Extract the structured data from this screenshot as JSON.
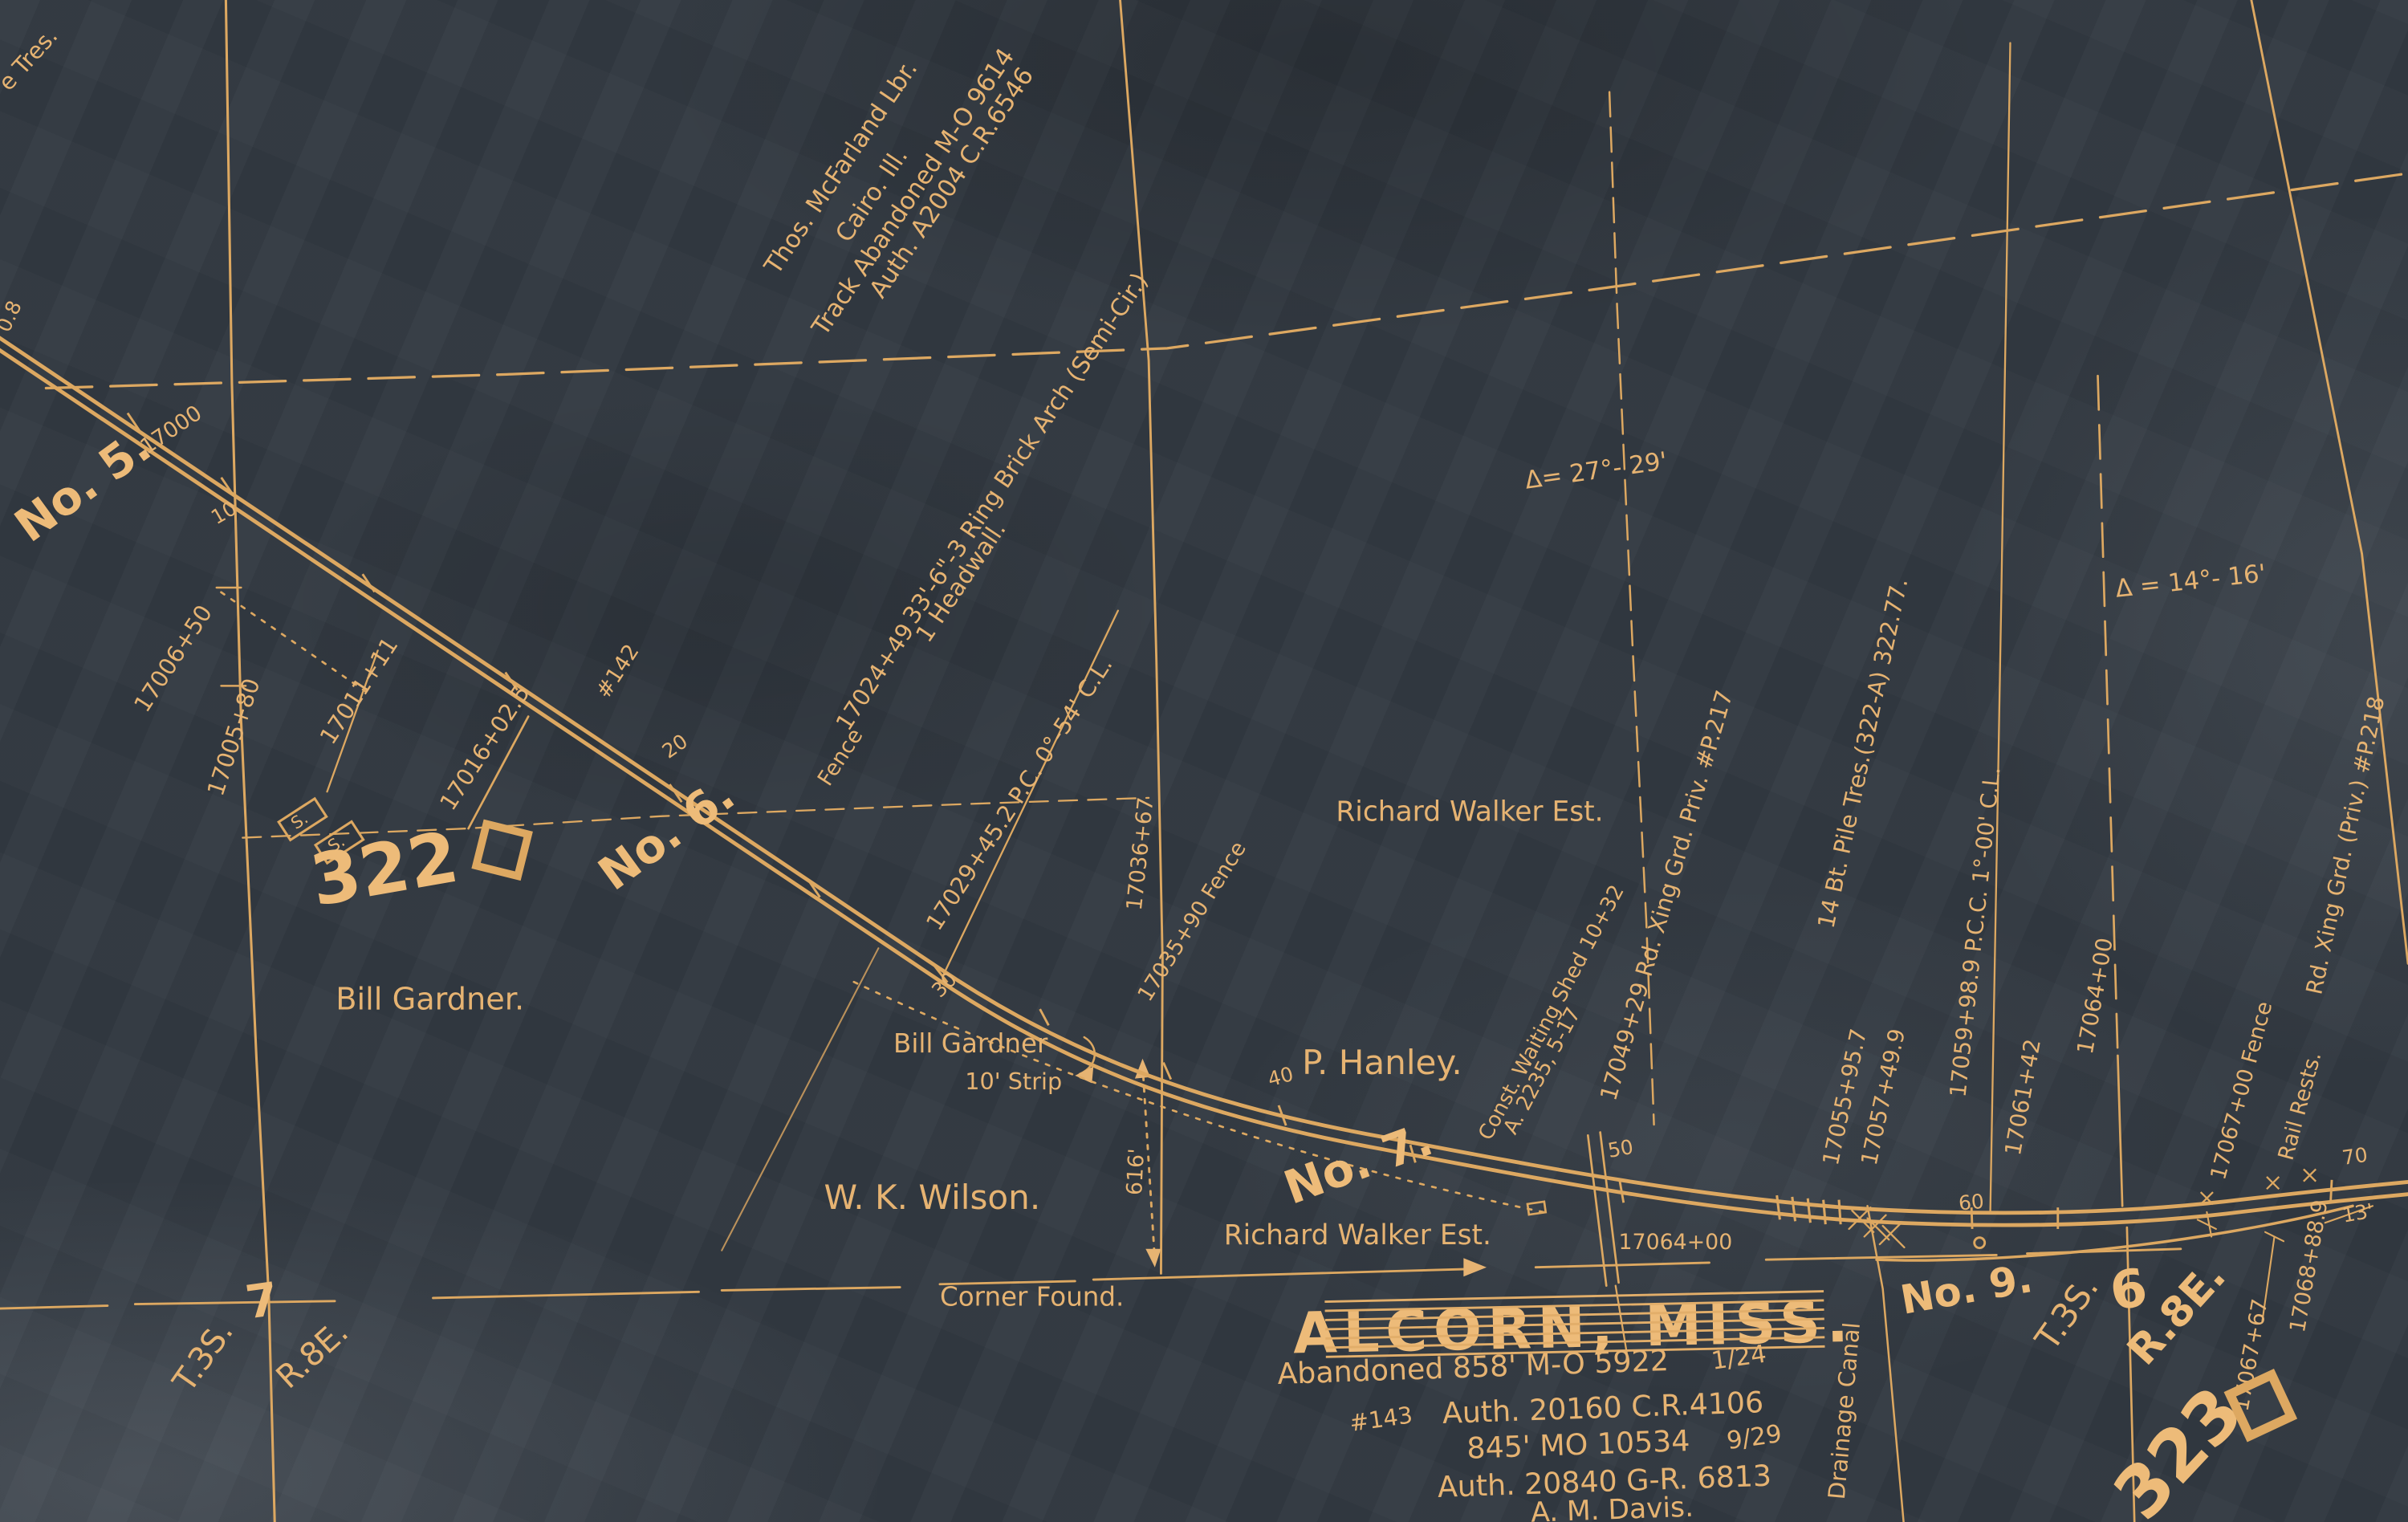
{
  "colors": {
    "ink": "#e6b372",
    "paper": "#333a42"
  },
  "corner_fragments": {
    "tres": "e Tres.",
    "zero_eight": "0.8"
  },
  "mcfarland_note": {
    "line1": "Thos. McFarland Lbr.",
    "line2": "Cairo. Ill.",
    "line3": "Track Abandoned M-O 9614",
    "line4": "Auth. A2004 C.R.6546"
  },
  "arch_note": {
    "line1": "33'-6\"-3 Ring Brick Arch (Semi-Cir.)",
    "line2": "1 Headwall."
  },
  "track": {
    "no5": "No. 5.",
    "no6": "No. 6.",
    "no7": "No. 7.",
    "no9": "No. 9.",
    "s17000": "17000",
    "s10": "10",
    "s20": "20",
    "s30": "30",
    "s40": "40",
    "s50": "50",
    "s60": "60",
    "s70": "70"
  },
  "station_notes": {
    "s17006_50": "17006+50",
    "s17005_80": "17005+80",
    "s17011_11": "17011+11",
    "s17016_02": "17016+02.5",
    "fence_word": "Fence",
    "s17024_49": "17024+49",
    "num142": "#142",
    "pc_note": "17029+45.2  P.C. 0°-54' C.L.",
    "s17036_67": "17036+67",
    "fence_17035": "17035+90 Fence",
    "rd_xing_217": "17049+29 Rd. Xing Grd. Priv. #P.217",
    "waiting_shed1": "Const. Waiting Shed 10+32",
    "waiting_shed2": "A. 2235, 5-17",
    "pile_trestle": "14 Bt. Pile Tres.(322-A) 322.77.",
    "s17055": "17055+95.7",
    "s17057": "17057+49.9",
    "pcc_note": "17059+98.9  P.C.C.  1°-00' C.L.",
    "s17061": "17061+42",
    "s17064_v": "17064+00",
    "s17064_h": "17064+00",
    "fence_17067": "17067+00 Fence",
    "rail_rests": "Rail Rests.",
    "s17068": "17068+88.9",
    "s17067_67": "17067+67",
    "thirteen": "13'",
    "rd_xing_218": "Rd. Xing Grd. (Priv.) #P.218",
    "delta27": "Δ= 27°- 29'",
    "delta14": "Δ = 14°- 16'",
    "dim_616": "616'"
  },
  "landowners": {
    "hanley": "P. Hanley.",
    "walker1": "Richard Walker Est.",
    "walker2": "Richard Walker Est.",
    "gardner1": "Bill Gardner.",
    "gardner2": "Bill Gardner",
    "strip": "10' Strip",
    "wilson": "W. K. Wilson.",
    "corner": "Corner Found."
  },
  "sections": {
    "s322": "322",
    "s323": "323",
    "sec7": "7",
    "sec6": "6",
    "t3s_left": "T.3S.",
    "r8e_left": "R.8E.",
    "t3s_right": "T.3S.",
    "r8e_right": "R.8E."
  },
  "ss_sign": {
    "s1": "S.",
    "s2": "S."
  },
  "title_block": {
    "name": "ALCORN, MISS.",
    "abandoned1": "Abandoned 858' M-O 5922",
    "date1": "1/24",
    "auth1": "Auth. 20160 C.R.4106",
    "num143": "#143",
    "abandoned2": "845' MO 10534",
    "date2": "9/29",
    "auth2": "Auth. 20840 G-R. 6813",
    "engineer": "A. M. Davis."
  },
  "canal": "Drainage Canal"
}
